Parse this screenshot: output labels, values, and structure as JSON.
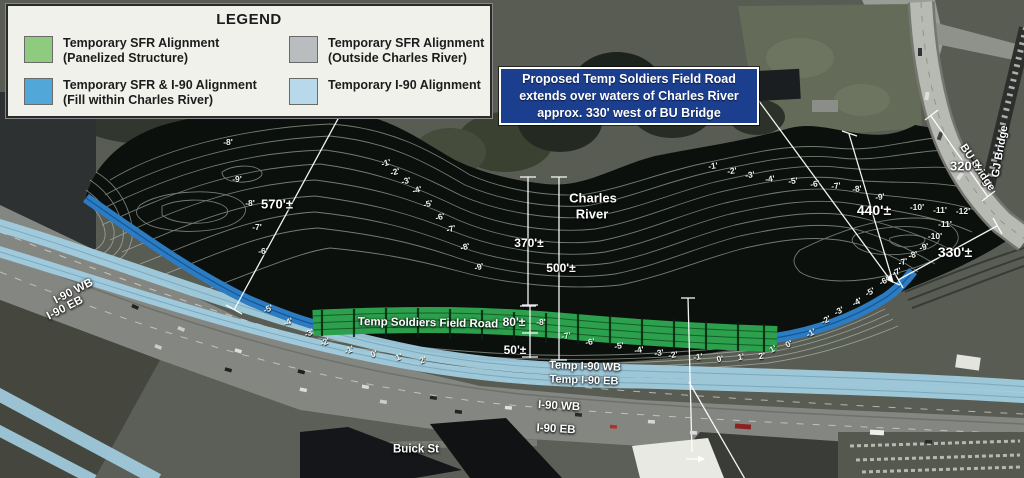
{
  "legend": {
    "title": "LEGEND",
    "items": [
      {
        "swatch": "#8ecb7e",
        "line1": "Temporary SFR Alignment",
        "line2": "(Panelized Structure)",
        "x": 16,
        "y": 30
      },
      {
        "swatch": "#b9bdbf",
        "line1": "Temporary SFR Alignment",
        "line2": "(Outside Charles River)",
        "x": 281,
        "y": 30
      },
      {
        "swatch": "#51a7d7",
        "line1": "Temporary SFR & I-90 Alignment",
        "line2": "(Fill within Charles River)",
        "x": 16,
        "y": 72
      },
      {
        "swatch": "#b7d9ea",
        "line1": "Temporary I-90 Alignment",
        "line2": "",
        "x": 281,
        "y": 72
      }
    ]
  },
  "callout": {
    "line1": "Proposed Temp Soldiers Field Road",
    "line2": "extends over waters of Charles River",
    "line3": "approx. 330' west of BU Bridge"
  },
  "map_labels": [
    {
      "text": "Charles",
      "x": 593,
      "y": 198,
      "size": 13,
      "cls": "ctr"
    },
    {
      "text": "River",
      "x": 592,
      "y": 214,
      "size": 13,
      "cls": "ctr"
    },
    {
      "text": "Temp Soldiers Field Road",
      "x": 428,
      "y": 324,
      "size": 11.5,
      "rot": 1,
      "cls": "ctr"
    },
    {
      "text": "Temp I-90 WB",
      "x": 585,
      "y": 367,
      "size": 11,
      "rot": 2,
      "cls": "ctr"
    },
    {
      "text": "Temp I-90 EB",
      "x": 584,
      "y": 381,
      "size": 11,
      "rot": 2,
      "cls": "ctr"
    },
    {
      "text": "I-90 WB",
      "x": 559,
      "y": 407,
      "size": 11.5,
      "rot": 3,
      "cls": "ctr"
    },
    {
      "text": "I-90 EB",
      "x": 556,
      "y": 430,
      "size": 11.5,
      "rot": 3,
      "cls": "ctr"
    },
    {
      "text": "I-90 WB",
      "x": 55,
      "y": 296,
      "size": 11.5,
      "rot": -27,
      "cls": "anch"
    },
    {
      "text": "I-90 EB",
      "x": 48,
      "y": 312,
      "size": 11.5,
      "rot": -27,
      "cls": "anch"
    },
    {
      "text": "Buick St",
      "x": 416,
      "y": 450,
      "size": 11.5,
      "cls": "ctr"
    },
    {
      "text": "BU  Bridge",
      "x": 962,
      "y": 140,
      "size": 11,
      "rot": 56,
      "cls": "anch"
    },
    {
      "text": "GJ  Bridge",
      "x": 996,
      "y": 172,
      "size": 11,
      "rot": -80,
      "cls": "anch"
    }
  ],
  "measurements": [
    {
      "text": "570'±",
      "x": 277,
      "y": 204,
      "size": 13
    },
    {
      "text": "370'±",
      "x": 529,
      "y": 243,
      "size": 12
    },
    {
      "text": "500'±",
      "x": 561,
      "y": 268,
      "size": 12
    },
    {
      "text": "440'±",
      "x": 874,
      "y": 210,
      "size": 14
    },
    {
      "text": "320'±",
      "x": 966,
      "y": 166,
      "size": 13
    },
    {
      "text": "330'±",
      "x": 955,
      "y": 252,
      "size": 14
    },
    {
      "text": "80'±",
      "x": 514,
      "y": 322,
      "size": 12
    },
    {
      "text": "50'±",
      "x": 515,
      "y": 350,
      "size": 12
    }
  ],
  "depth_labels": [
    {
      "text": "-8'",
      "x": 228,
      "y": 142
    },
    {
      "text": "-9'",
      "x": 237,
      "y": 179
    },
    {
      "text": "-8'",
      "x": 250,
      "y": 203
    },
    {
      "text": "-7'",
      "x": 257,
      "y": 227
    },
    {
      "text": "-6'",
      "x": 263,
      "y": 251
    },
    {
      "text": "-1'",
      "x": 386,
      "y": 163,
      "rot": -15
    },
    {
      "text": "-2'",
      "x": 395,
      "y": 172,
      "rot": -15
    },
    {
      "text": "-3'",
      "x": 406,
      "y": 181,
      "rot": -15
    },
    {
      "text": "-4'",
      "x": 417,
      "y": 190,
      "rot": -15
    },
    {
      "text": "-5'",
      "x": 428,
      "y": 204,
      "rot": -15
    },
    {
      "text": "-6'",
      "x": 440,
      "y": 217,
      "rot": -15
    },
    {
      "text": "-7'",
      "x": 451,
      "y": 229,
      "rot": -15
    },
    {
      "text": "-8'",
      "x": 465,
      "y": 247,
      "rot": -15
    },
    {
      "text": "-9'",
      "x": 479,
      "y": 267,
      "rot": -15
    },
    {
      "text": "-1'",
      "x": 713,
      "y": 166,
      "rot": -8
    },
    {
      "text": "-2'",
      "x": 732,
      "y": 171,
      "rot": -8
    },
    {
      "text": "-3'",
      "x": 750,
      "y": 175,
      "rot": -8
    },
    {
      "text": "-4'",
      "x": 770,
      "y": 179,
      "rot": -8
    },
    {
      "text": "-5'",
      "x": 793,
      "y": 181,
      "rot": -8
    },
    {
      "text": "-6'",
      "x": 815,
      "y": 184,
      "rot": -8
    },
    {
      "text": "-7'",
      "x": 836,
      "y": 186,
      "rot": -8
    },
    {
      "text": "-8'",
      "x": 857,
      "y": 189,
      "rot": -8
    },
    {
      "text": "-9'",
      "x": 880,
      "y": 197,
      "rot": -8
    },
    {
      "text": "-10'",
      "x": 917,
      "y": 207
    },
    {
      "text": "-11'",
      "x": 940,
      "y": 210
    },
    {
      "text": "-12'",
      "x": 963,
      "y": 211
    },
    {
      "text": "-11'",
      "x": 945,
      "y": 224
    },
    {
      "text": "-10'",
      "x": 935,
      "y": 236
    },
    {
      "text": "-9'",
      "x": 924,
      "y": 247,
      "rot": -15
    },
    {
      "text": "-8'",
      "x": 913,
      "y": 255,
      "rot": -15
    },
    {
      "text": "-7'",
      "x": 903,
      "y": 262,
      "rot": -15
    },
    {
      "text": "-5'",
      "x": 268,
      "y": 309,
      "rot": -22
    },
    {
      "text": "-4'",
      "x": 288,
      "y": 322,
      "rot": -22
    },
    {
      "text": "-3'",
      "x": 309,
      "y": 333,
      "rot": -22
    },
    {
      "text": "-2'",
      "x": 325,
      "y": 342,
      "rot": -22
    },
    {
      "text": "-1'",
      "x": 349,
      "y": 350,
      "rot": -22
    },
    {
      "text": "0'",
      "x": 374,
      "y": 354,
      "rot": -22
    },
    {
      "text": "1'",
      "x": 399,
      "y": 357,
      "rot": -22
    },
    {
      "text": "2'",
      "x": 423,
      "y": 360,
      "rot": -22
    },
    {
      "text": "-8'",
      "x": 541,
      "y": 322
    },
    {
      "text": "-7'",
      "x": 566,
      "y": 336,
      "rot": -10
    },
    {
      "text": "-6'",
      "x": 590,
      "y": 342,
      "rot": -10
    },
    {
      "text": "-5'",
      "x": 619,
      "y": 346,
      "rot": -10
    },
    {
      "text": "-4'",
      "x": 639,
      "y": 350,
      "rot": -10
    },
    {
      "text": "-3'",
      "x": 659,
      "y": 353,
      "rot": -10
    },
    {
      "text": "-2'",
      "x": 673,
      "y": 355,
      "rot": -10
    },
    {
      "text": "-1'",
      "x": 698,
      "y": 357,
      "rot": -10
    },
    {
      "text": "0'",
      "x": 720,
      "y": 359,
      "rot": -10
    },
    {
      "text": "1'",
      "x": 741,
      "y": 357,
      "rot": -10
    },
    {
      "text": "2'",
      "x": 762,
      "y": 356,
      "rot": -10
    },
    {
      "text": "1'",
      "x": 773,
      "y": 349,
      "rot": -28
    },
    {
      "text": "0'",
      "x": 789,
      "y": 344,
      "rot": -28
    },
    {
      "text": "-1'",
      "x": 811,
      "y": 333,
      "rot": -28
    },
    {
      "text": "-2'",
      "x": 826,
      "y": 320,
      "rot": -28
    },
    {
      "text": "-3'",
      "x": 839,
      "y": 311,
      "rot": -28
    },
    {
      "text": "-4'",
      "x": 857,
      "y": 302,
      "rot": -28
    },
    {
      "text": "-5'",
      "x": 870,
      "y": 292,
      "rot": -28
    },
    {
      "text": "-6'",
      "x": 884,
      "y": 281,
      "rot": -28
    },
    {
      "text": "-7'",
      "x": 897,
      "y": 272,
      "rot": -28
    }
  ],
  "colors": {
    "band_green": "#2ca04d",
    "fill_blue": "#2d7cc2",
    "temp_blue": "#a3cfe3",
    "callout_bg": "#1c3e8e",
    "water": "#0b100d"
  }
}
